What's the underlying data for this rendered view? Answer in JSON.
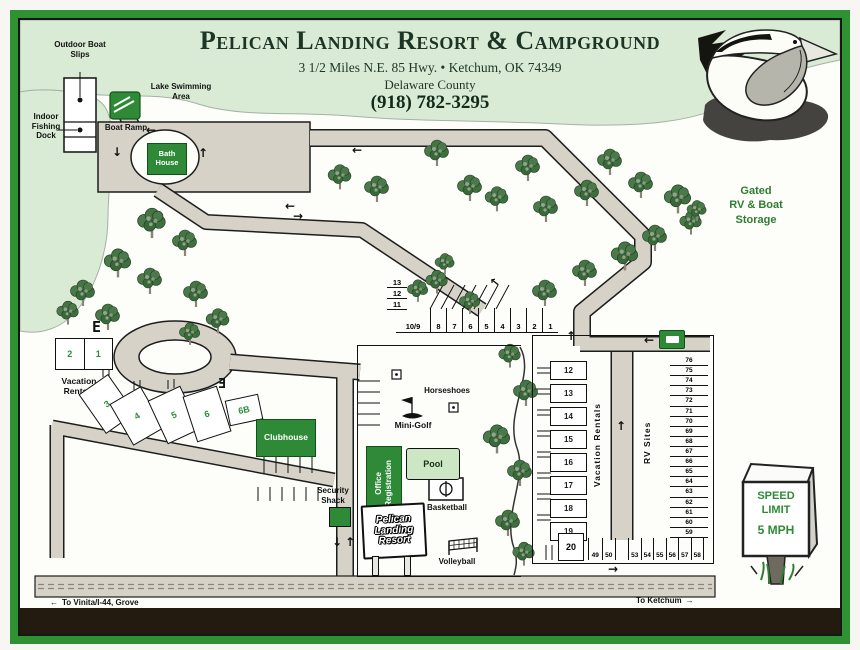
{
  "header": {
    "title": "Pelican Landing Resort & Campground",
    "address": "3 1/2 Miles N.E. 85 Hwy. • Ketchum, OK 74349",
    "county": "Delaware County",
    "phone": "(918) 782-3295"
  },
  "waterfront": {
    "outdoor_boat_slips": "Outdoor Boat Slips",
    "indoor_fishing_dock": "Indoor Fishing Dock",
    "lake_swimming_area": "Lake Swimming Area",
    "boat_ramp": "Boat Ramp",
    "bath_house": "Bath House"
  },
  "amenities": {
    "clubhouse": "Clubhouse",
    "mini_golf": "Mini-Golf",
    "horseshoes": "Horseshoes",
    "pool": "Pool",
    "office": [
      "Office",
      "Registration"
    ],
    "basketball": "Basketball",
    "volleyball": "Volleyball",
    "security_shack": "Security Shack",
    "resort_sign": [
      "Pelican",
      "Landing",
      "Resort"
    ]
  },
  "rentals": {
    "label": "Vacation Rentals",
    "west_pair": [
      "2",
      "1"
    ],
    "hill_sites": [
      "3",
      "4",
      "5",
      "6",
      "6B"
    ],
    "east_label": "Vacation Rentals",
    "east_sites": [
      "12",
      "13",
      "14",
      "15",
      "16",
      "17",
      "18",
      "19"
    ],
    "site_20": "20"
  },
  "rv": {
    "label": "RV Sites",
    "row_sites": [
      "10/9",
      "8",
      "7",
      "6",
      "5",
      "4",
      "3",
      "2",
      "1"
    ],
    "stack_sites": [
      "13",
      "12",
      "11"
    ],
    "bottom_pair": [
      "49",
      "50"
    ],
    "bottom_row": [
      "53",
      "54",
      "55",
      "56",
      "57",
      "58"
    ],
    "east_column": [
      "76",
      "75",
      "74",
      "73",
      "72",
      "71",
      "70",
      "69",
      "68",
      "67",
      "66",
      "65",
      "64",
      "63",
      "62",
      "61",
      "60",
      "59"
    ]
  },
  "storage_sign": [
    "Gated",
    "RV & Boat",
    "Storage"
  ],
  "speed_sign": [
    "SPEED",
    "LIMIT",
    "5 MPH"
  ],
  "directions": {
    "west": "To Vinita/I-44, Grove",
    "east": "To Ketchum"
  },
  "markers": {
    "e_west": "E",
    "e_mid": "Ǝ"
  },
  "icons": {
    "left": "←",
    "right": "→",
    "up": "↑",
    "down": "↓"
  },
  "colors": {
    "frame_green": "#2f9232",
    "header_green": "#d9ebd5",
    "road_tan": "#d6d2c8",
    "building_green": "#2f8a38",
    "pool_green": "#cde7c5",
    "title_green": "#1d3526",
    "sign_text_green": "#2f7d33"
  }
}
